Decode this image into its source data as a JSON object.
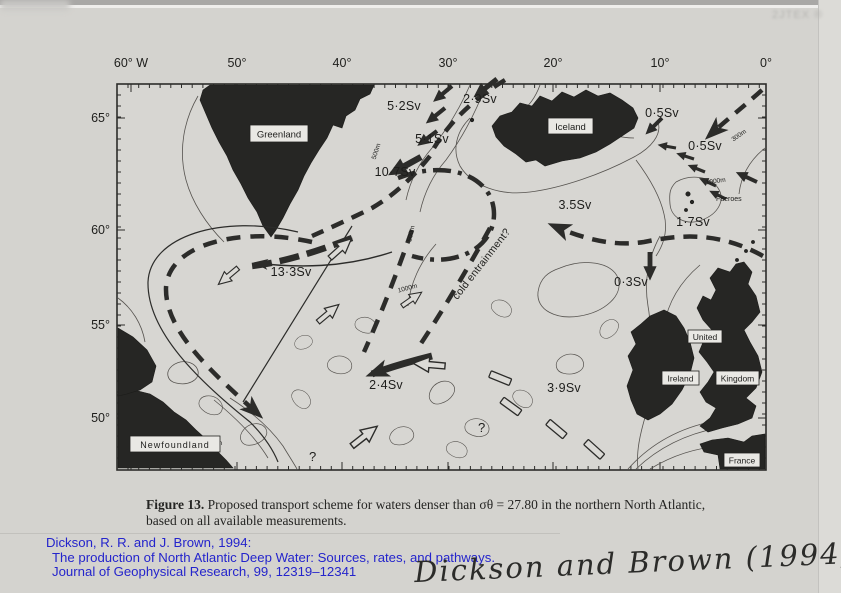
{
  "colors": {
    "citation_blue": "#2424cc",
    "ink": "#2c2c2a",
    "paper": "#d4d3cf",
    "land": "#262624"
  },
  "scan": {
    "stamp_text": "2JTEX ®"
  },
  "map": {
    "top_axis": [
      "60° W",
      "50°",
      "40°",
      "30°",
      "20°",
      "10°",
      "0°"
    ],
    "left_axis": [
      "65°",
      "60°",
      "55°",
      "50°"
    ],
    "sv_labels": [
      "5·2Sv",
      "2·9Sv",
      "0·5Sv",
      "0·5Sv",
      "5·1Sv",
      "10·7Sv",
      "3.5Sv",
      "1·7Sv",
      "13·3Sv",
      "0·3Sv",
      "2·4Sv",
      "3·9Sv"
    ],
    "place_labels": {
      "greenland": "Greenland",
      "iceland": "Iceland",
      "faeroes": "Faeroes",
      "united": "United",
      "kingdom": "Kingdom",
      "ireland": "Ireland",
      "france": "France",
      "newfoundland": "Newfoundland"
    },
    "annotation": "cold entrainment?",
    "contour_labels": [
      "500m",
      "500m",
      "300m",
      "1000m",
      "1000m",
      "200m"
    ],
    "question_marks": [
      "?",
      "?"
    ]
  },
  "caption": {
    "label": "Figure 13.",
    "line1": "Proposed transport scheme for waters denser than σθ = 27.80 in the northern North Atlantic,",
    "line2": "based on all available measurements."
  },
  "citation": {
    "line1": "Dickson, R. R. and J. Brown, 1994:",
    "line2": "The production of North Atlantic Deep Water: Sources, rates, and pathways.",
    "line3": "Journal of Geophysical Research, 99, 12319–12341"
  },
  "handwriting": "Dickson and Brown (1994)"
}
